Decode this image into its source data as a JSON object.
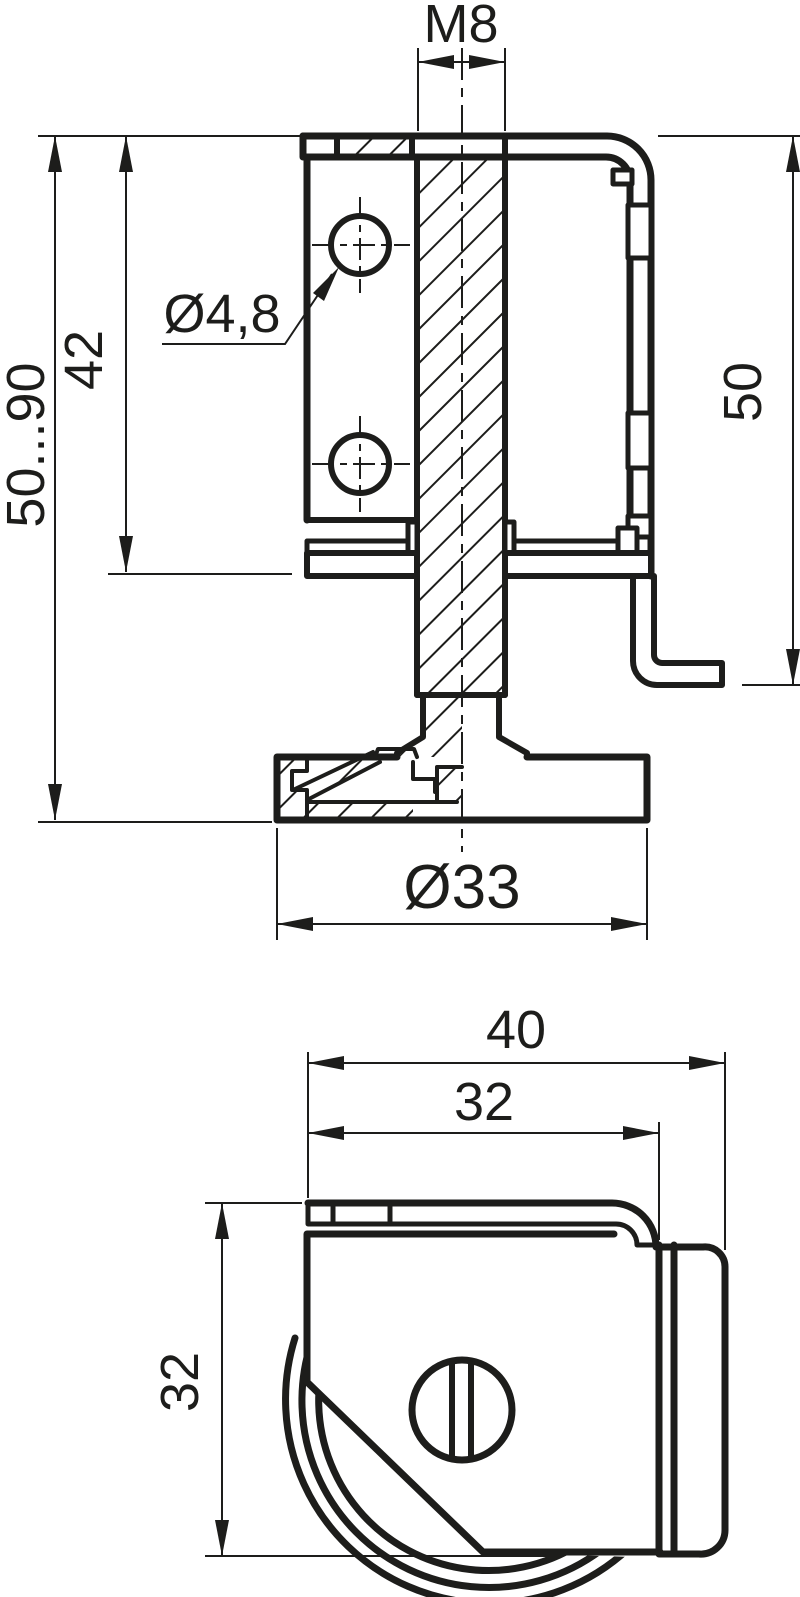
{
  "drawing": {
    "type": "technical-drawing",
    "subject": "adjustable cabinet leveler foot with mounting bracket, two orthographic views",
    "colors": {
      "line": "#1d1d1b",
      "background": "#ffffff"
    },
    "views": {
      "front": {
        "name": "front-section-view",
        "labels": {
          "thread": "M8",
          "hole_diameter": "Ø4,8",
          "height_range": "50...90",
          "hole_spacing": "42",
          "bracket_height": "50",
          "foot_diameter": "Ø33"
        }
      },
      "side": {
        "name": "side-view",
        "labels": {
          "overall_width": "40",
          "plate_width": "32",
          "plate_height": "32"
        }
      }
    }
  }
}
